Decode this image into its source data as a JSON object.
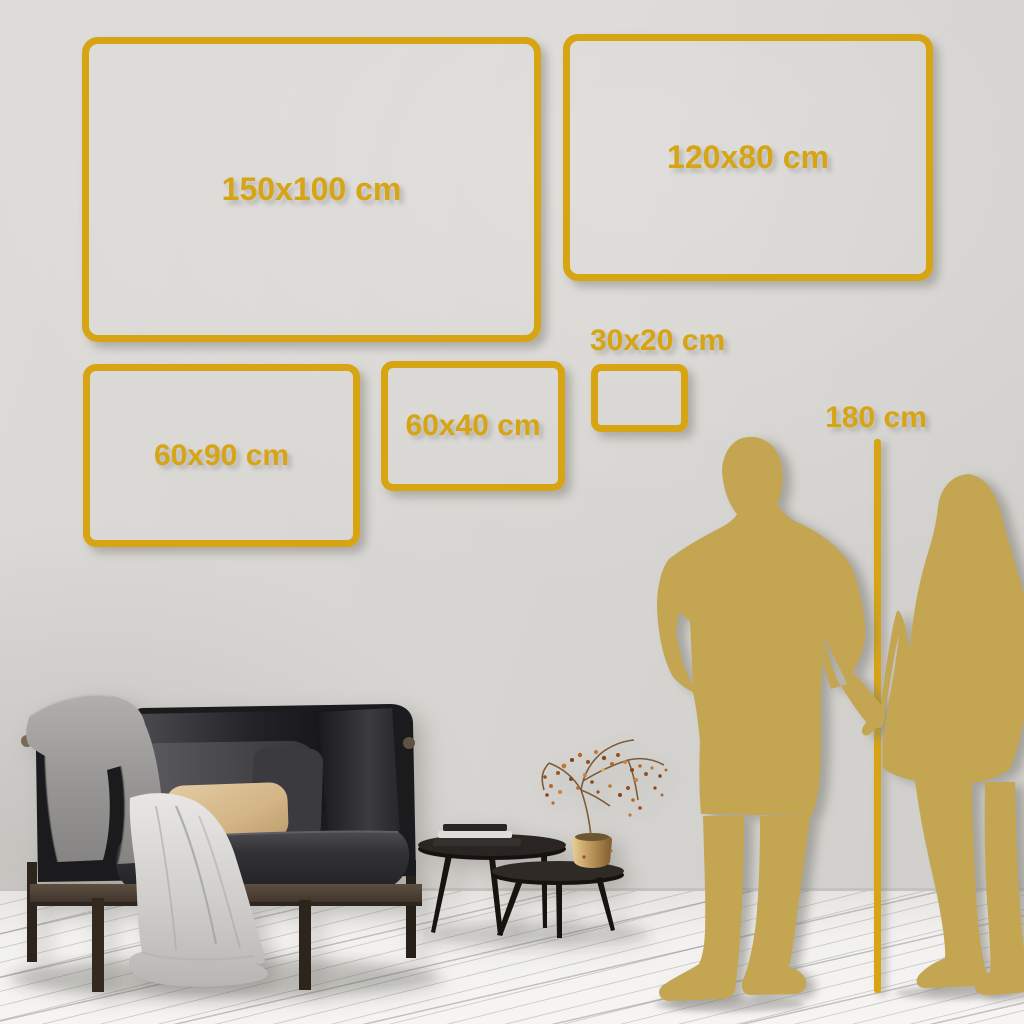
{
  "scene": {
    "description": "Wall art size comparison guide in a living room with sofa, coffee tables and a couple silhouette for scale"
  },
  "colors": {
    "accent": "#d7a413",
    "silhouette": "#c3a552",
    "wall": "#d8d6d2",
    "floor": "#f2f1ef"
  },
  "size_frames": [
    {
      "id": "150x100",
      "label": "150x100 cm",
      "width_cm": 150,
      "height_cm": 100
    },
    {
      "id": "120x80",
      "label": "120x80 cm",
      "width_cm": 120,
      "height_cm": 80
    },
    {
      "id": "60x90",
      "label": "60x90 cm",
      "width_cm": 60,
      "height_cm": 90
    },
    {
      "id": "60x40",
      "label": "60x40 cm",
      "width_cm": 60,
      "height_cm": 40
    },
    {
      "id": "30x20",
      "label": "30x20 cm",
      "width_cm": 30,
      "height_cm": 20
    }
  ],
  "height_reference": {
    "label": "180 cm",
    "value_cm": 180
  }
}
